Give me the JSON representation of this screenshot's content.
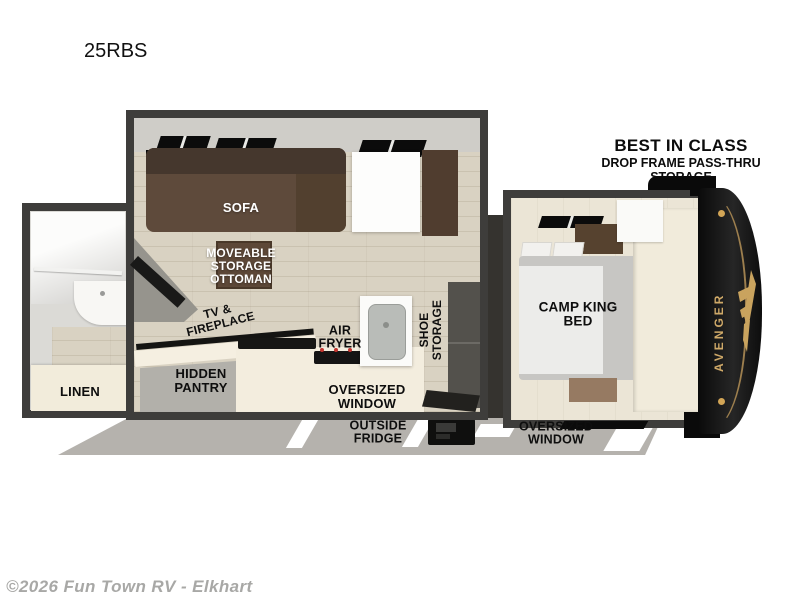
{
  "title": "25RBS",
  "callout": {
    "line1": "BEST IN CLASS",
    "line2": "DROP FRAME PASS-THRU",
    "line3": "STORAGE"
  },
  "labels": {
    "sofa": "SOFA",
    "ottoman": "MOVEABLE\nSTORAGE\nOTTOMAN",
    "tv_fireplace": "TV &\nFIREPLACE",
    "hidden_pantry": "HIDDEN\nPANTRY",
    "linen": "LINEN",
    "air_fryer": "AIR\nFRYER",
    "shoe_storage": "SHOE\nSTORAGE",
    "oversized_window_main": "OVERSIZED\nWINDOW",
    "outside_fridge": "OUTSIDE\nFRIDGE",
    "oversized_window_bedroom": "OVERSIZED\nWINDOW",
    "camp_king_bed": "CAMP KING\nBED"
  },
  "brand": "AVENGER",
  "watermark": "©2026 Fun Town RV - Elkhart",
  "colors": {
    "wall": "#3e3d3b",
    "floor_wood": "#d9d2c2",
    "sofa_brown": "#5e4a3b",
    "cabinet_brown": "#503d2f",
    "counter_cream": "#f3edde",
    "skirt_gray": "#b5b2ad",
    "cap_black": "#101010",
    "accent_gold": "#c9a35e"
  }
}
